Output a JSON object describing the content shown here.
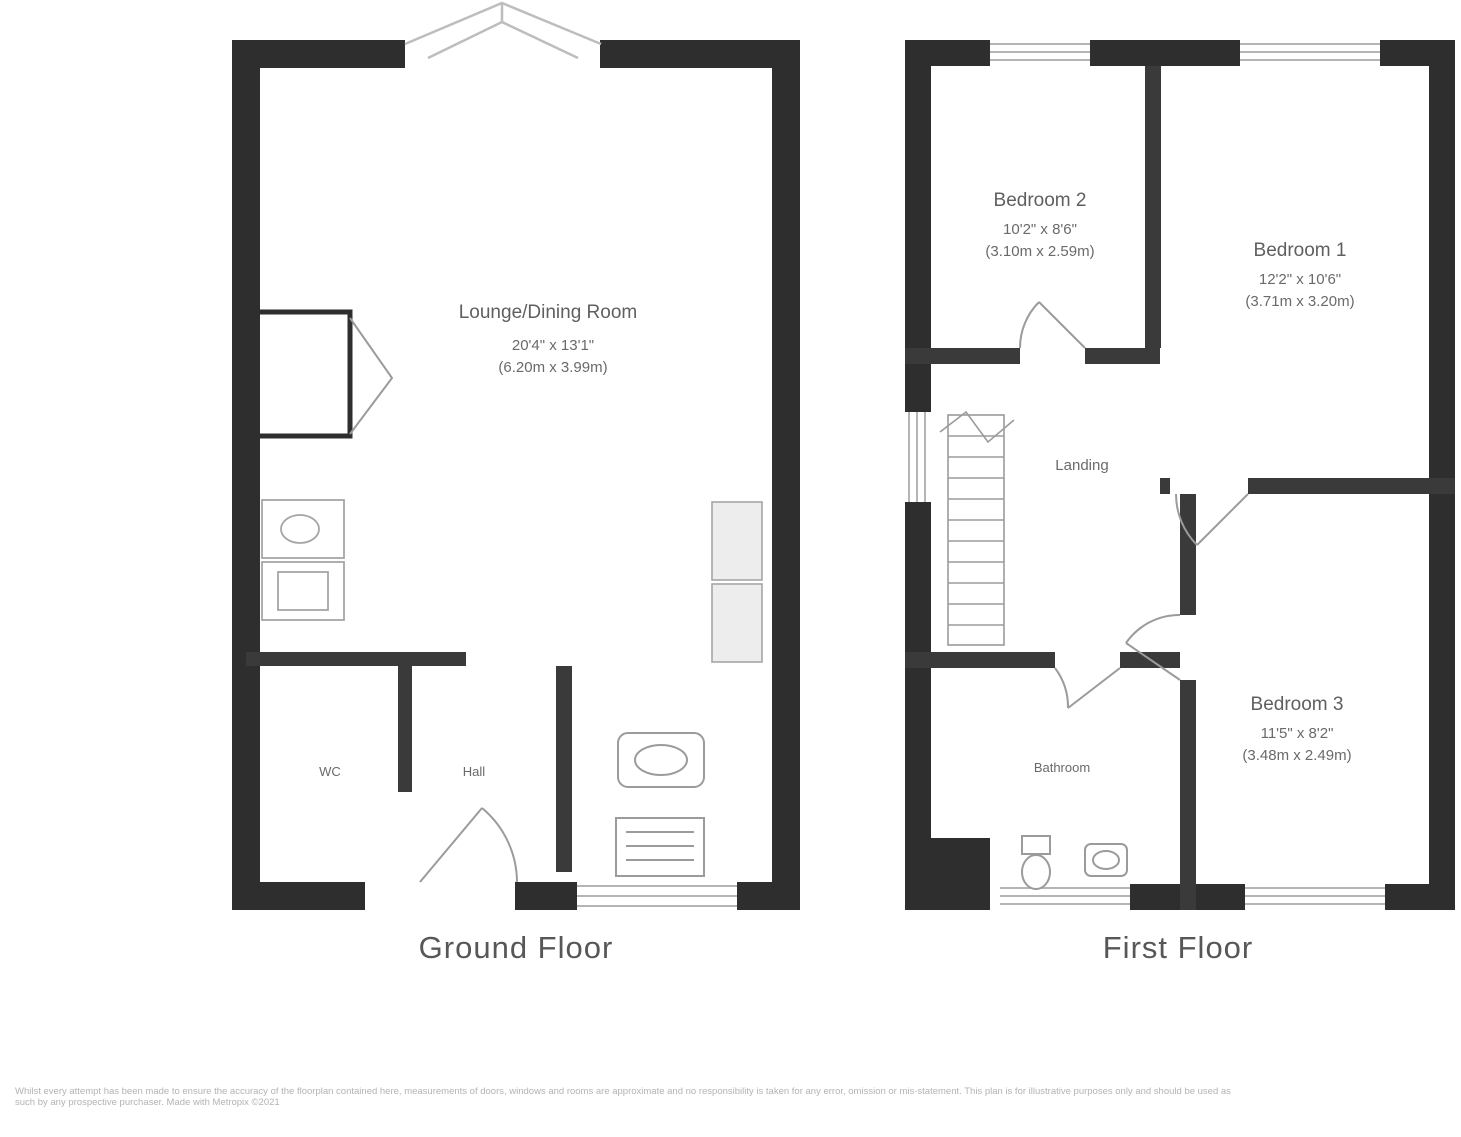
{
  "document": {
    "kind": "property-floorplan",
    "background": "#ffffff"
  },
  "colors": {
    "exterior_wall": "#2e2e2e",
    "interior_wall": "#3a3a3a",
    "window_line": "#b5b5b5",
    "thin_line": "#9b9b9b",
    "fixture_line": "#a5a5a5",
    "unit_fill": "#ededed",
    "label_text": "#5f5f5f",
    "caption_text": "#575757",
    "disclaimer_text": "#b3b3b3"
  },
  "ground_floor": {
    "caption": "Ground Floor",
    "lounge": {
      "name": "Lounge/Dining Room",
      "dims_imperial": "20'4\" x 13'1\"",
      "dims_metric": "(6.20m x 3.99m)"
    },
    "wc_label": "WC",
    "hall_label": "Hall"
  },
  "first_floor": {
    "caption": "First Floor",
    "bedroom2": {
      "name": "Bedroom 2",
      "dims_imperial": "10'2\" x 8'6\"",
      "dims_metric": "(3.10m x 2.59m)"
    },
    "bedroom1": {
      "name": "Bedroom 1",
      "dims_imperial": "12'2\" x 10'6\"",
      "dims_metric": "(3.71m x 3.20m)"
    },
    "bedroom3": {
      "name": "Bedroom 3",
      "dims_imperial": "11'5\" x 8'2\"",
      "dims_metric": "(3.48m x 2.49m)"
    },
    "landing_label": "Landing",
    "bathroom_label": "Bathroom"
  },
  "footer": {
    "disclaimer": "Whilst every attempt has been made to ensure the accuracy of the floorplan contained here, measurements of doors, windows and rooms are approximate and no responsibility is taken for any error, omission or mis-statement. This plan is for illustrative purposes only and should be used as such by any prospective purchaser. Made with Metropix ©2021"
  }
}
